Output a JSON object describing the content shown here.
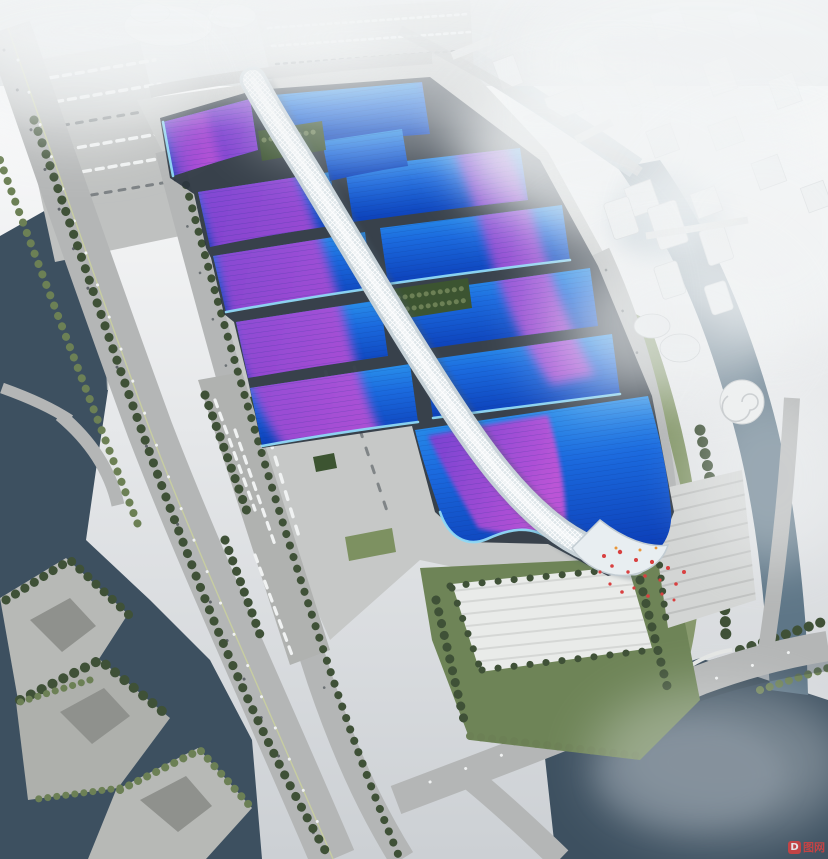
{
  "meta": {
    "type": "architectural-aerial-rendering",
    "description": "Bird's-eye rendering of a giant exhibition & convention center: rows of blue halls with sweeping purple ribbon bands on the roofs, a white serpentine lattice concourse running down the middle, surrounded by expressways, canals, rivers, parks and fog-shrouded white city blocks."
  },
  "watermark": {
    "logo_letter": "D",
    "text": "图网"
  },
  "scene": {
    "regions": [
      {
        "name": "exhibition-halls",
        "note": "blue gradient roofs with purple ribbons"
      },
      {
        "name": "central-concourse",
        "note": "white diagrid serpentine spine"
      },
      {
        "name": "south-lobby",
        "note": "wave-edged head building with magenta patch"
      },
      {
        "name": "entrance-plaza",
        "note": "striped white plaza, palms, red crowd dots"
      },
      {
        "name": "left-expressway",
        "note": "elevated road with ramps over river"
      },
      {
        "name": "left-river",
        "note": "dark teal water, bottom-left terraced park"
      },
      {
        "name": "right-river",
        "note": "canal curving along east side with bridges"
      },
      {
        "name": "city-blocks",
        "note": "white buildings fading into fog"
      }
    ],
    "colors": {
      "sky_haze": "#d3d7da",
      "roof_blue_deep": "#0c3fb8",
      "roof_blue": "#1b6ade",
      "roof_cyan": "#2f9ff0",
      "roof_rim_cyan": "#8fd9f5",
      "ribbon_purple": "#7b3fd0",
      "ribbon_magenta": "#c454d6",
      "spine_white": "#eef3f5",
      "water_dark": "#3d5060",
      "water_mid": "#5e7687",
      "water_light": "#9fb4c0",
      "road": "#b4b6b6",
      "apron": "#c6c8c7",
      "plaza": "#e9ebe9",
      "tree_dark": "#3f5137",
      "tree_light": "#6c8055",
      "lawn": "#7d9161",
      "building_white": "#e8ebec",
      "fog": "#f2f4f5",
      "accent_red": "#d84040"
    }
  }
}
